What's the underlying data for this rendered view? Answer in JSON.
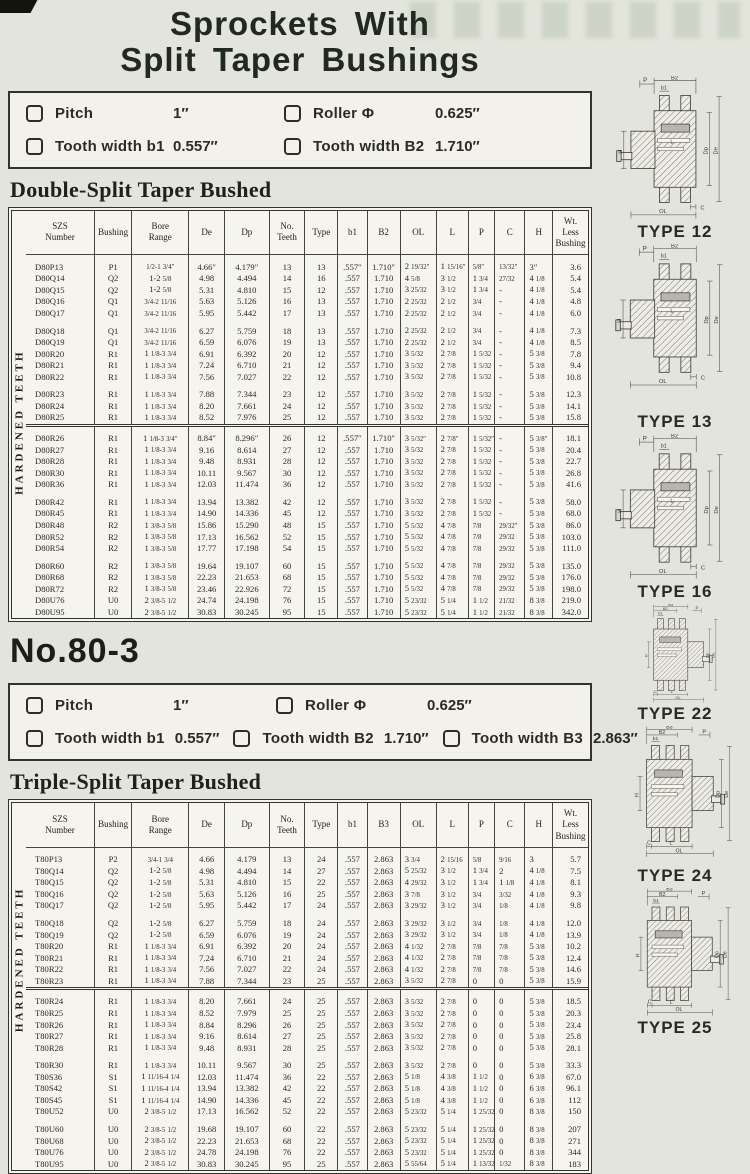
{
  "page": {
    "title_line1": "Sprockets With",
    "title_line2": "Split Taper Bushings"
  },
  "spec1": {
    "items": [
      {
        "label": "Pitch",
        "value": "1″"
      },
      {
        "label": "Roller Φ",
        "value": "0.625″"
      },
      {
        "label": "Tooth width b1",
        "value": "0.557″"
      },
      {
        "label": "Tooth width B2",
        "value": "1.710″"
      }
    ]
  },
  "section1_heading": "Double-Split Taper Bushed",
  "section2_number": "No.80-3",
  "spec2": {
    "items": [
      {
        "label": "Pitch",
        "value": "1″"
      },
      {
        "label": "Roller Φ",
        "value": "0.625″"
      },
      {
        "label": "Tooth width b1",
        "value": "0.557″"
      },
      {
        "label": "Tooth width B2",
        "value": "1.710″"
      },
      {
        "label": "Tooth width B3",
        "value": "2.863″"
      }
    ]
  },
  "section2_heading": "Triple-Split Taper Bushed",
  "table1": {
    "vertical_label": "HARDENED TEETH",
    "columns": [
      "SZS\nNumber",
      "Bushing",
      "Bore\nRange",
      "De",
      "Dp",
      "No.\nTeeth",
      "Type",
      "b1",
      "B2",
      "OL",
      "L",
      "P",
      "C",
      "H",
      "Wt.\nLess\nBushing"
    ],
    "heavy_sep_before": [
      3
    ],
    "groups": [
      [
        [
          "D80P13",
          "P1",
          "1/2-1 3/4″",
          "4.66″",
          "4.179″",
          "13",
          "13",
          ".557″",
          "1.710″",
          "2 19/32″",
          "1 15/16″",
          "5/8″",
          "13/32″",
          "3″",
          "3.6"
        ],
        [
          "D80Q14",
          "Q2",
          "1-2 5/8",
          "4.98",
          "4.494",
          "14",
          "16",
          ".557",
          "1.710",
          "4 5/8",
          "3 1/2",
          "1 3/4",
          "27/32",
          "4 1/8",
          "5.4"
        ],
        [
          "D80Q15",
          "Q2",
          "1-2 5/8",
          "5.31",
          "4.810",
          "15",
          "12",
          ".557",
          "1.710",
          "3 25/32",
          "3 1/2",
          "1 3/4",
          "-",
          "4 1/8",
          "5.4"
        ],
        [
          "D80Q16",
          "Q1",
          "3/4-2 11/16",
          "5.63",
          "5.126",
          "16",
          "13",
          ".557",
          "1.710",
          "2 25/32",
          "2 1/2",
          "3/4",
          "-",
          "4 1/8",
          "4.8"
        ],
        [
          "D80Q17",
          "Q1",
          "3/4-2 11/16",
          "5.95",
          "5.442",
          "17",
          "13",
          ".557",
          "1.710",
          "2 25/32",
          "2 1/2",
          "3/4",
          "-",
          "4 1/8",
          "6.0"
        ]
      ],
      [
        [
          "D80Q18",
          "Q1",
          "3/4-2 11/16",
          "6.27",
          "5.759",
          "18",
          "13",
          ".557",
          "1.710",
          "2 25/32",
          "2 1/2",
          "3/4",
          "-",
          "4 1/8",
          "7.3"
        ],
        [
          "D80Q19",
          "Q1",
          "3/4-2 11/16",
          "6.59",
          "6.076",
          "19",
          "13",
          ".557",
          "1.710",
          "2 25/32",
          "2 1/2",
          "3/4",
          "-",
          "4 1/8",
          "8.5"
        ],
        [
          "D80R20",
          "R1",
          "1 1/8-3 3/4",
          "6.91",
          "6.392",
          "20",
          "12",
          ".557",
          "1.710",
          "3 5/32",
          "2 7/8",
          "1 5/32",
          "-",
          "5 3/8",
          "7.8"
        ],
        [
          "D80R21",
          "R1",
          "1 1/8-3 3/4",
          "7.24",
          "6.710",
          "21",
          "12",
          ".557",
          "1.710",
          "3 5/32",
          "2 7/8",
          "1 5/32",
          "-",
          "5 3/8",
          "9.4"
        ],
        [
          "D80R22",
          "R1",
          "1 1/8-3 3/4",
          "7.56",
          "7.027",
          "22",
          "12",
          ".557",
          "1.710",
          "3 5/32",
          "2 7/8",
          "1 5/32",
          "-",
          "5 3/8",
          "10.8"
        ]
      ],
      [
        [
          "D80R23",
          "R1",
          "1 1/8-3 3/4",
          "7.88",
          "7.344",
          "23",
          "12",
          ".557",
          "1.710",
          "3 5/32",
          "2 7/8",
          "1 5/32",
          "-",
          "5 3/8",
          "12.3"
        ],
        [
          "D80R24",
          "R1",
          "1 1/8-3 3/4",
          "8.20",
          "7.661",
          "24",
          "12",
          ".557",
          "1.710",
          "3 5/32",
          "2 7/8",
          "1 5/32",
          "-",
          "5 3/8",
          "14.1"
        ],
        [
          "D80R25",
          "R1",
          "1 1/8-3 3/4",
          "8.52",
          "7.976",
          "25",
          "12",
          ".557",
          "1.710",
          "3 5/32",
          "2 7/8",
          "1 5/32",
          "-",
          "5 3/8",
          "15.8"
        ]
      ],
      [
        [
          "D80R26",
          "R1",
          "1 1/8-3 3/4″",
          "8.84″",
          "8.296″",
          "26",
          "12",
          ".557″",
          "1.710″",
          "3 5/32″",
          "2 7/8″",
          "1 5/32″",
          "-",
          "5 3/8″",
          "18.1"
        ],
        [
          "D80R27",
          "R1",
          "1 1/8-3 3/4",
          "9.16",
          "8.614",
          "27",
          "12",
          ".557",
          "1.710",
          "3 5/32",
          "2 7/8",
          "1 5/32",
          "-",
          "5 3/8",
          "20.4"
        ],
        [
          "D80R28",
          "R1",
          "1 1/8-3 3/4",
          "9.48",
          "8.931",
          "28",
          "12",
          ".557",
          "1.710",
          "3 5/32",
          "2 7/8",
          "1 5/32",
          "-",
          "5 3/8",
          "22.7"
        ],
        [
          "D80R30",
          "R1",
          "1 1/8-3 3/4",
          "10.11",
          "9.567",
          "30",
          "12",
          ".557",
          "1.710",
          "3 5/32",
          "2 7/8",
          "1 5/32",
          "-",
          "5 3/8",
          "26.8"
        ],
        [
          "D80R36",
          "R1",
          "1 1/8-3 3/4",
          "12.03",
          "11.474",
          "36",
          "12",
          ".557",
          "1.710",
          "3 5/32",
          "2 7/8",
          "1 5/32",
          "-",
          "5 3/8",
          "41.6"
        ]
      ],
      [
        [
          "D80R42",
          "R1",
          "1 1/8-3 3/4",
          "13.94",
          "13.382",
          "42",
          "12",
          ".557",
          "1.710",
          "3 5/32",
          "2 7/8",
          "1 5/32",
          "-",
          "5 3/8",
          "58.0"
        ],
        [
          "D80R45",
          "R1",
          "1 1/8-3 3/4",
          "14.90",
          "14.336",
          "45",
          "12",
          ".557",
          "1.710",
          "3 5/32",
          "2 7/8",
          "1 5/32",
          "-",
          "5 3/8",
          "68.0"
        ],
        [
          "D80R48",
          "R2",
          "1 3/8-3 5/8",
          "15.86",
          "15.290",
          "48",
          "15",
          ".557",
          "1.710",
          "5 5/32",
          "4 7/8",
          "7/8",
          "29/32″",
          "5 3/8",
          "86.0"
        ],
        [
          "D80R52",
          "R2",
          "1 3/8-3 5/8",
          "17.13",
          "16.562",
          "52",
          "15",
          ".557",
          "1.710",
          "5 5/32",
          "4 7/8",
          "7/8",
          "29/32",
          "5 3/8",
          "103.0"
        ],
        [
          "D80R54",
          "R2",
          "1 3/8-3 5/8",
          "17.77",
          "17.198",
          "54",
          "15",
          ".557",
          "1.710",
          "5 5/32",
          "4 7/8",
          "7/8",
          "29/32",
          "5 3/8",
          "111.0"
        ]
      ],
      [
        [
          "D80R60",
          "R2",
          "1 3/8-3 5/8",
          "19.64",
          "19.107",
          "60",
          "15",
          ".557",
          "1.710",
          "5 5/32",
          "4 7/8",
          "7/8",
          "29/32",
          "5 3/8",
          "135.0"
        ],
        [
          "D80R68",
          "R2",
          "1 3/8-3 5/8",
          "22.23",
          "21.653",
          "68",
          "15",
          ".557",
          "1.710",
          "5 5/32",
          "4 7/8",
          "7/8",
          "29/32",
          "5 3/8",
          "176.0"
        ],
        [
          "D80R72",
          "R2",
          "1 3/8-3 5/8",
          "23.46",
          "22.926",
          "72",
          "15",
          ".557",
          "1.710",
          "5 5/32",
          "4 7/8",
          "7/8",
          "29/32",
          "5 3/8",
          "198.0"
        ],
        [
          "D80U76",
          "U0",
          "2 3/8-5 1/2",
          "24.74",
          "24.198",
          "76",
          "15",
          ".557",
          "1.710",
          "5 23/32",
          "5 1/4",
          "1 1/2",
          "21/32",
          "8 3/8",
          "219.0"
        ],
        [
          "D80U95",
          "U0",
          "2 3/8-5 1/2",
          "30.83",
          "30.245",
          "95",
          "15",
          ".557",
          "1.710",
          "5 23/32",
          "5 1/4",
          "1 1/2",
          "21/32",
          "8 3/8",
          "342.0"
        ]
      ]
    ]
  },
  "table2": {
    "vertical_label": "HARDENED TEETH",
    "columns": [
      "SZS\nNumber",
      "Bushing",
      "Bore\nRange",
      "De",
      "Dp",
      "No.\nTeeth",
      "Type",
      "b1",
      "B3",
      "OL",
      "L",
      "P",
      "C",
      "H",
      "Wt.\nLess\nBushing"
    ],
    "heavy_sep_before": [
      2
    ],
    "groups": [
      [
        [
          "T80P13",
          "P2",
          "3/4-1 3/4",
          "4.66",
          "4.179",
          "13",
          "24",
          ".557",
          "2.863",
          "3 3/4",
          "2 15/16",
          "5/8",
          "9/16",
          "3",
          "5.7"
        ],
        [
          "T80Q14",
          "Q2",
          "1-2 5/8",
          "4.98",
          "4.494",
          "14",
          "27",
          ".557",
          "2.863",
          "5 25/32",
          "3 1/2",
          "1 3/4",
          "2",
          "4 1/8",
          "7.5"
        ],
        [
          "T80Q15",
          "Q2",
          "1-2 5/8",
          "5.31",
          "4.810",
          "15",
          "22",
          ".557",
          "2.863",
          "4 29/32",
          "3 1/2",
          "1 3/4",
          "1 1/8",
          "4 1/8",
          "8.1"
        ],
        [
          "T80Q16",
          "Q2",
          "1-2 5/8",
          "5.63",
          "5.126",
          "16",
          "25",
          ".557",
          "2.863",
          "3 7/8",
          "3 1/2",
          "3/4",
          "3/32",
          "4 1/8",
          "9.3"
        ],
        [
          "T80Q17",
          "Q2",
          "1-2 5/8",
          "5.95",
          "5.442",
          "17",
          "24",
          ".557",
          "2.863",
          "3 29/32",
          "3 1/2",
          "3/4",
          "1/8",
          "4 1/8",
          "9.8"
        ]
      ],
      [
        [
          "T80Q18",
          "Q2",
          "1-2 5/8",
          "6.27",
          "5.759",
          "18",
          "24",
          ".557",
          "2.863",
          "3 29/32",
          "3 1/2",
          "3/4",
          "1/8",
          "4 1/8",
          "12.0"
        ],
        [
          "T80Q19",
          "Q2",
          "1-2 5/8",
          "6.59",
          "6.076",
          "19",
          "24",
          ".557",
          "2.863",
          "3 29/32",
          "3 1/2",
          "3/4",
          "1/8",
          "4 1/8",
          "13.9"
        ],
        [
          "T80R20",
          "R1",
          "1 1/8-3 3/4",
          "6.91",
          "6.392",
          "20",
          "24",
          ".557",
          "2.863",
          "4 1/32",
          "2 7/8",
          "7/8",
          "7/8",
          "5 3/8",
          "10.2"
        ],
        [
          "T80R21",
          "R1",
          "1 1/8-3 3/4",
          "7.24",
          "6.710",
          "21",
          "24",
          ".557",
          "2.863",
          "4 1/32",
          "2 7/8",
          "7/8",
          "7/8",
          "5 3/8",
          "12.4"
        ],
        [
          "T80R22",
          "R1",
          "1 1/8-3 3/4",
          "7.56",
          "7.027",
          "22",
          "24",
          ".557",
          "2.863",
          "4 1/32",
          "2 7/8",
          "7/8",
          "7/8",
          "5 3/8",
          "14.6"
        ],
        [
          "T80R23",
          "R1",
          "1 1/8-3 3/4",
          "7.88",
          "7.344",
          "23",
          "25",
          ".557",
          "2.863",
          "3 5/32",
          "2 7/8",
          "0",
          "0",
          "5 3/8",
          "15.9"
        ]
      ],
      [
        [
          "T80R24",
          "R1",
          "1 1/8-3 3/4",
          "8.20",
          "7.661",
          "24",
          "25",
          ".557",
          "2.863",
          "3 5/32",
          "2 7/8",
          "0",
          "0",
          "5 3/8",
          "18.5"
        ],
        [
          "T80R25",
          "R1",
          "1 1/8-3 3/4",
          "8.52",
          "7.979",
          "25",
          "25",
          ".557",
          "2.863",
          "3 5/32",
          "2 7/8",
          "0",
          "0",
          "5 3/8",
          "20.3"
        ],
        [
          "T80R26",
          "R1",
          "1 1/8-3 3/4",
          "8.84",
          "8.296",
          "26",
          "25",
          ".557",
          "2.863",
          "3 5/32",
          "2 7/8",
          "0",
          "0",
          "5 3/8",
          "23.4"
        ],
        [
          "T80R27",
          "R1",
          "1 1/8-3 3/4",
          "9.16",
          "8.614",
          "27",
          "25",
          ".557",
          "2.863",
          "3 5/32",
          "2 7/8",
          "0",
          "0",
          "5 3/8",
          "25.8"
        ],
        [
          "T80R28",
          "R1",
          "1 1/8-3 3/4",
          "9.48",
          "8.931",
          "28",
          "25",
          ".557",
          "2.863",
          "3 5/32",
          "2 7/8",
          "0",
          "0",
          "5 3/8",
          "28.1"
        ]
      ],
      [
        [
          "T80R30",
          "R1",
          "1 1/8-3 3/4",
          "10.11",
          "9.567",
          "30",
          "25",
          ".557",
          "2.863",
          "3 5/32",
          "2 7/8",
          "0",
          "0",
          "5 3/8",
          "33.3"
        ],
        [
          "T80S36",
          "S1",
          "1 11/16-4 1/4",
          "12.03",
          "11.474",
          "36",
          "22",
          ".557",
          "2.863",
          "5 1/8",
          "4 3/8",
          "1 1/2",
          "0",
          "6 3/8",
          "67.0"
        ],
        [
          "T80S42",
          "S1",
          "1 11/16-4 1/4",
          "13.94",
          "13.382",
          "42",
          "22",
          ".557",
          "2.863",
          "5 1/8",
          "4 3/8",
          "1 1/2",
          "0",
          "6 3/8",
          "96.1"
        ],
        [
          "T80S45",
          "S1",
          "1 11/16-4 1/4",
          "14.90",
          "14.336",
          "45",
          "22",
          ".557",
          "2.863",
          "5 1/8",
          "4 3/8",
          "1 1/2",
          "0",
          "6 3/8",
          "112"
        ],
        [
          "T80U52",
          "U0",
          "2 3/8-5 1/2",
          "17.13",
          "16.562",
          "52",
          "22",
          ".557",
          "2.863",
          "5 23/32",
          "5 1/4",
          "1 25/32",
          "0",
          "8 3/8",
          "150"
        ]
      ],
      [
        [
          "T80U60",
          "U0",
          "2 3/8-5 1/2",
          "19.68",
          "19.107",
          "60",
          "22",
          ".557",
          "2.863",
          "5 23/32",
          "5 1/4",
          "1 25/32",
          "0",
          "8 3/8",
          "207"
        ],
        [
          "T80U68",
          "U0",
          "2 3/8-5 1/2",
          "22.23",
          "21.653",
          "68",
          "22",
          ".557",
          "2.863",
          "5 23/32",
          "5 1/4",
          "1 25/32",
          "0",
          "8 3/8",
          "271"
        ],
        [
          "T80U76",
          "U0",
          "2 3/8-5 1/2",
          "24.78",
          "24.198",
          "76",
          "22",
          ".557",
          "2.863",
          "5 23/32",
          "5 1/4",
          "1 25/32",
          "0",
          "8 3/8",
          "344"
        ],
        [
          "T80U95",
          "U0",
          "2 3/8-5 1/2",
          "30.83",
          "30.245",
          "95",
          "25",
          ".557",
          "2.863",
          "5 55/64",
          "5 1/4",
          "1 13/32",
          "1/32",
          "8 3/8",
          "183"
        ]
      ]
    ]
  },
  "diagrams": [
    {
      "label": "TYPE 12",
      "rows": 2
    },
    {
      "label": "TYPE 13",
      "rows": 2
    },
    {
      "label": "TYPE 16",
      "rows": 2
    },
    {
      "label": "TYPE 22",
      "rows": 3
    },
    {
      "label": "TYPE 24",
      "rows": 3
    },
    {
      "label": "TYPE 25",
      "rows": 3
    }
  ],
  "dim_labels": {
    "P": "P",
    "B1": "b1",
    "B2": "B2",
    "B3": "B3",
    "H": "H",
    "L": "L",
    "C": "C",
    "OL": "OL",
    "De": "De",
    "Dp": "Dp"
  },
  "colors": {
    "page_bg": "#e3e4db",
    "panel_bg": "#f5f4ed",
    "ink": "#2b2b26"
  }
}
